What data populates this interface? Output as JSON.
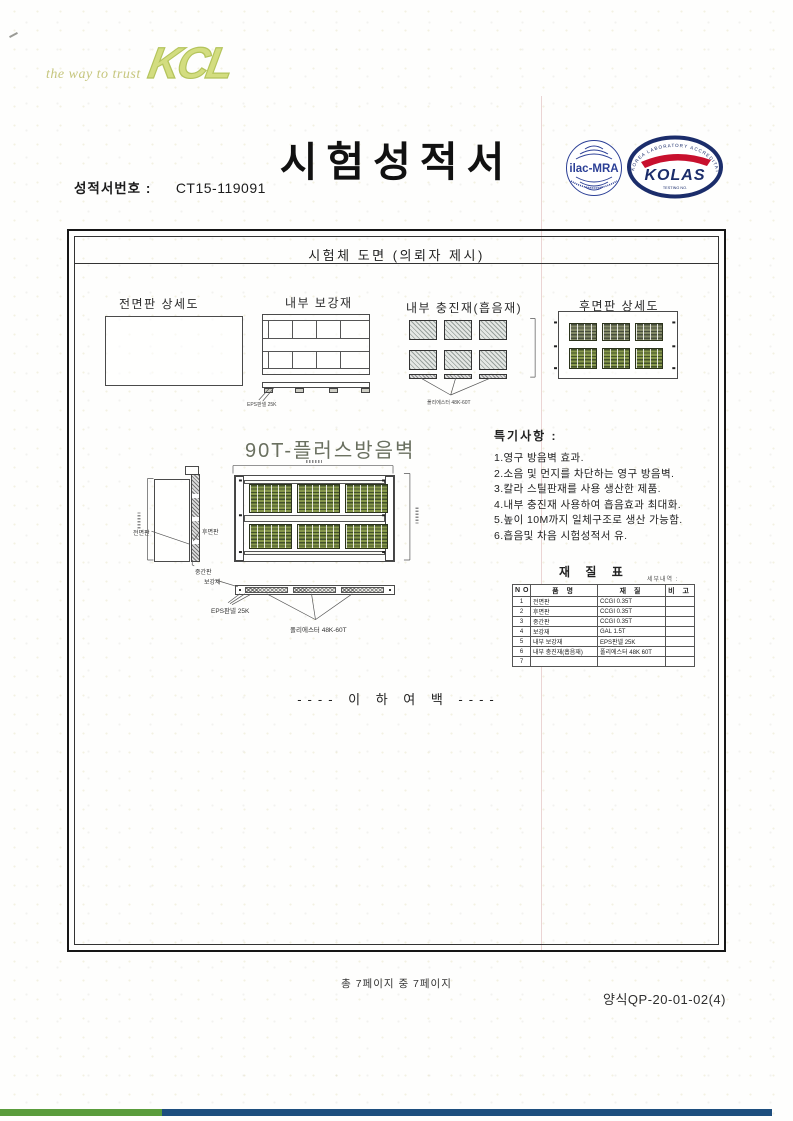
{
  "header": {
    "tagline": "the way to trust",
    "logo": "KCL",
    "title": "시험성적서",
    "report_no_label": "성적서번호 :",
    "report_no": "CT15-119091"
  },
  "certs": {
    "ilac_label": "ilac-MRA",
    "kolas_label": "KOLAS",
    "kolas_ring": "KOREA LABORATORY ACCREDITATION SCHEME",
    "kolas_sub": "TESTING NO."
  },
  "box": {
    "header": "시험체 도면 (의뢰자 제시)",
    "labels": {
      "front_detail": "전면판 상세도",
      "inner_reinf": "내부 보강재",
      "inner_filler": "내부 충진재(흡음재)",
      "rear_detail": "후면판 상세도",
      "product": "90T-플러스방음벽",
      "front_panel": "전면판",
      "rear_panel": "후면판",
      "mid_panel": "중간판",
      "reinf": "보강재",
      "eps": "EPS판넬 25K",
      "poly": "폴리에스터 48K-60T"
    },
    "notes": {
      "title": "특기사항 :",
      "items": [
        "1.영구 방음벽 효과.",
        "2.소음 및 먼지를 차단하는 영구 방음벽.",
        "3.칼라 스틸판재를 사용 생산한 제품.",
        "4.내부 충진재 사용하여 흡음효과 최대화.",
        "5.높이 10M까지 일체구조로 생산 가능함.",
        "6.흡음및 차음 시험성적서 유."
      ]
    },
    "material_table": {
      "title": "재 질 표",
      "side_note": "세부내역 :",
      "headers": [
        "NO",
        "품 명",
        "재 질",
        "비 고"
      ],
      "rows": [
        [
          "1",
          "전면판",
          "CCGI 0.35T",
          ""
        ],
        [
          "2",
          "후면판",
          "CCGI 0.35T",
          ""
        ],
        [
          "3",
          "중간판",
          "CCGI 0.35T",
          ""
        ],
        [
          "4",
          "보강재",
          "GAL 1.5T",
          ""
        ],
        [
          "5",
          "내부 보강재",
          "EPS판넬 25K",
          ""
        ],
        [
          "6",
          "내부 충진재(흡음재)",
          "폴리에스터 48K 60T",
          ""
        ],
        [
          "7",
          "",
          "",
          ""
        ]
      ]
    },
    "blank_below": "---- 이 하 여 백 ----"
  },
  "footer": {
    "page_info": "총 7페이지 중 7페이지",
    "form_no": "양식QP-20-01-02(4)"
  },
  "colors": {
    "logo_green": "#c5d461",
    "cert_blue": "#24368f",
    "cert_red": "#c8102e",
    "bar_green": "#5a9c3c",
    "bar_blue": "#1d4e7e",
    "panel_green_dark": "#42512a",
    "panel_green": "#87984b"
  }
}
